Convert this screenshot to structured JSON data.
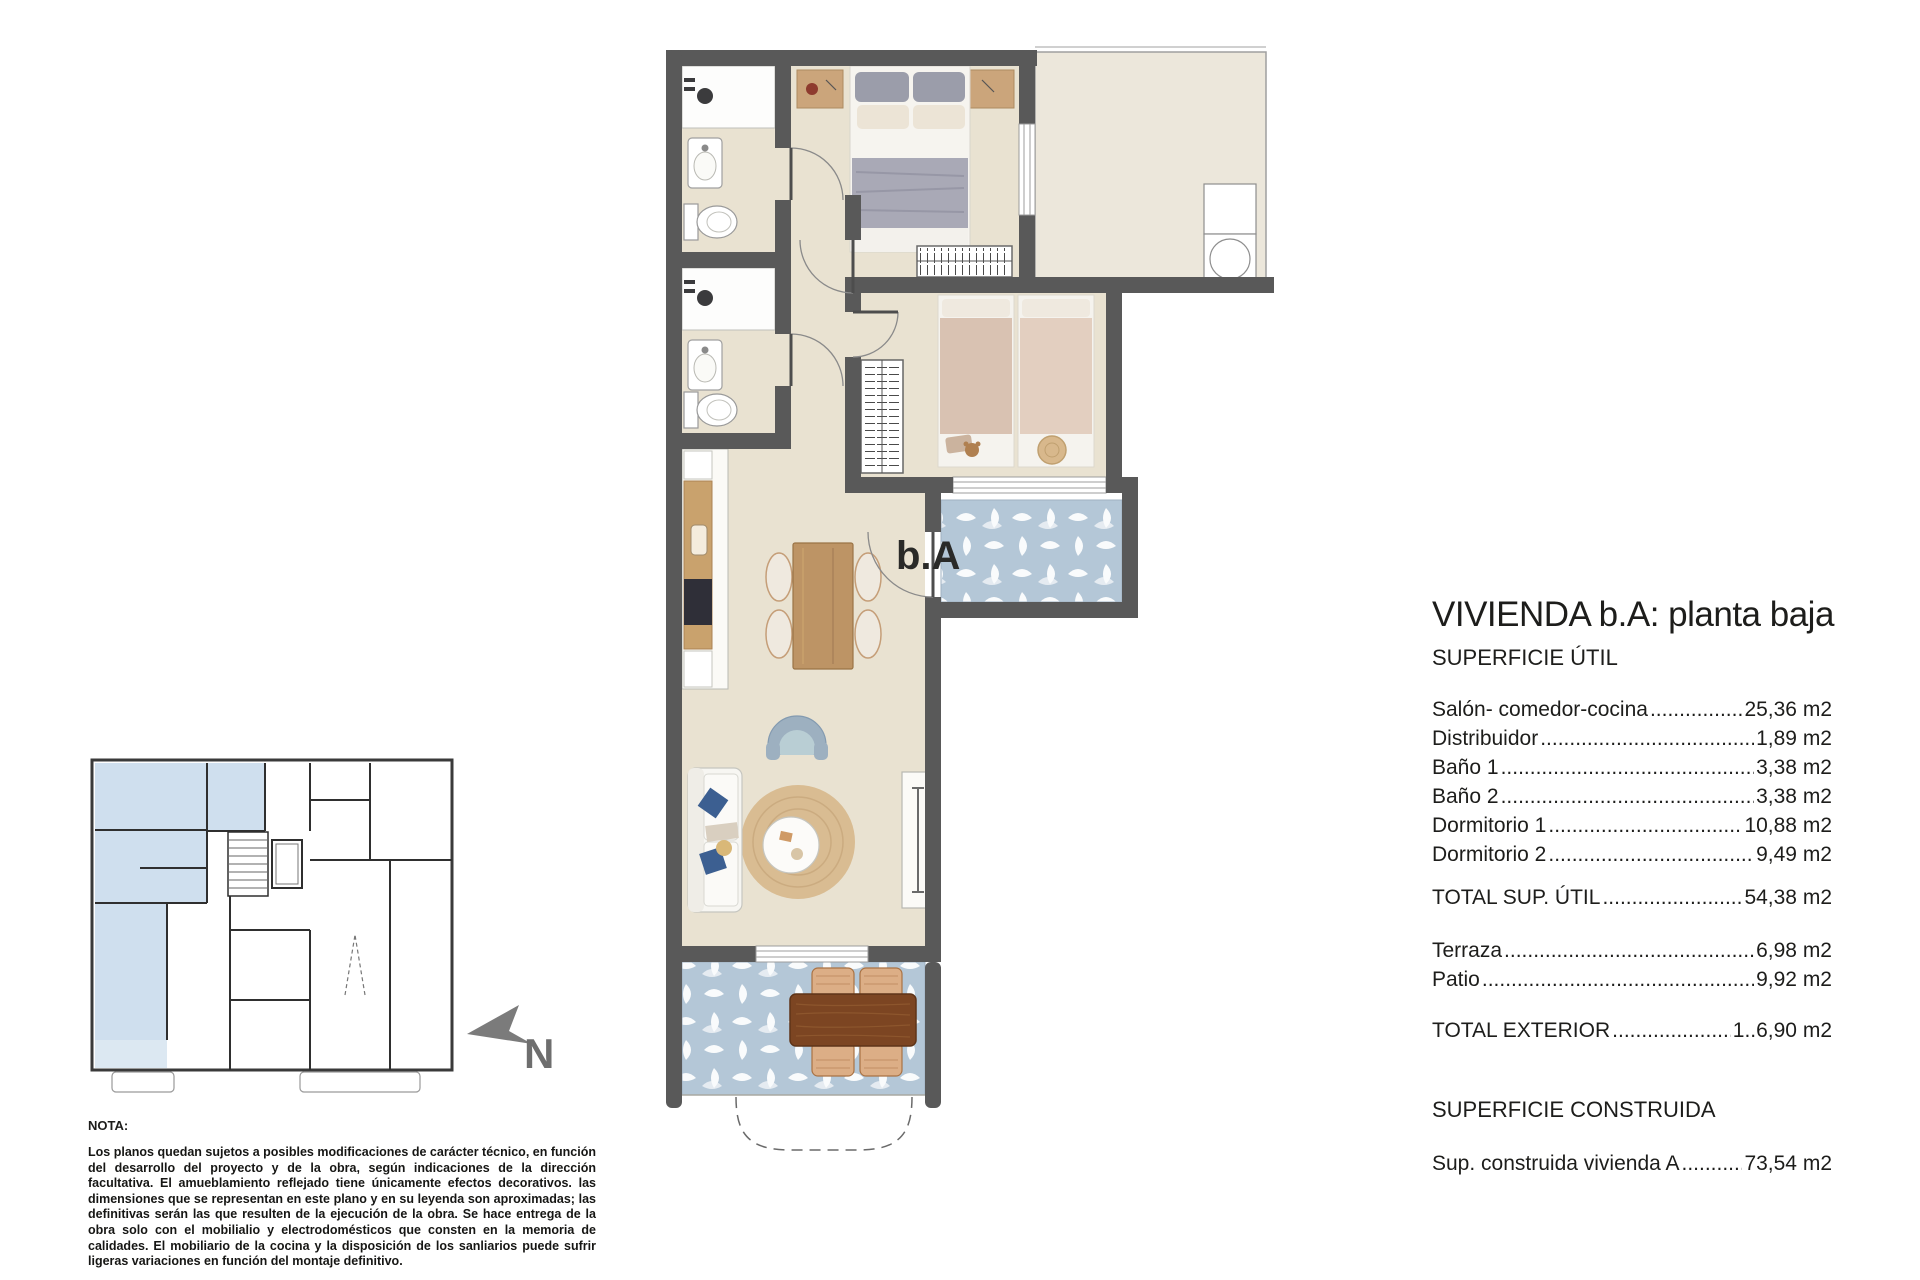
{
  "panel": {
    "title": "VIVIENDA b.A: planta baja",
    "surface_util_heading": "SUPERFICIE ÚTIL",
    "rows": [
      {
        "label": "Salón- comedor-cocina",
        "value": "25,36 m2"
      },
      {
        "label": "Distribuidor",
        "value": "1,89 m2"
      },
      {
        "label": "Baño 1",
        "value": "3,38 m2"
      },
      {
        "label": "Baño 2",
        "value": "3,38 m2"
      },
      {
        "label": "Dormitorio 1",
        "value": "10,88 m2"
      },
      {
        "label": "Dormitorio 2",
        "value": "9,49 m2"
      }
    ],
    "total_util": {
      "label": "TOTAL SUP. ÚTIL",
      "value": "54,38 m2"
    },
    "exterior_rows": [
      {
        "label": "Terraza",
        "value": "6,98 m2"
      },
      {
        "label": "Patio",
        "value": "9,92 m2"
      }
    ],
    "total_exterior": {
      "label": "TOTAL EXTERIOR",
      "value": "1..6,90 m2"
    },
    "construida_heading": "SUPERFICIE CONSTRUIDA",
    "construida_row": {
      "label": "Sup. construida vivienda A",
      "value": "73,54 m2"
    }
  },
  "plan": {
    "unit_label": "b.A"
  },
  "compass": {
    "label": "N"
  },
  "note": {
    "heading": "NOTA:",
    "body": "Los planos quedan sujetos a posibles modificaciones de carácter técnico, en función del desarrollo del proyecto y de la obra, según indicaciones de la dirección facultativa. El amueblamiento reflejado tiene únicamente efectos decorativos. las dimensiones que se representan en este plano y en su leyenda son aproximadas; las definitivas serán las que resulten de la ejecución de la obra. Se hace entrega de la obra solo con el mobilialio y electrodomésticos que consten en la memoria de calidades. El mobiliario de la cocina y la disposición de los sanliarios puede sufrir ligeras variaciones en función del montaje definitivo."
  },
  "colors": {
    "wall": "#595959",
    "floor_beige": "#e9e2d1",
    "patio_cream": "#ece7db",
    "tile_blue": "#b4c7d7",
    "keyplan_highlight": "#cfdfee",
    "wood_light": "#bd9465",
    "wood_dark": "#7c4522",
    "text": "#1d1d1b",
    "north_arrow": "#7b7b7b"
  }
}
